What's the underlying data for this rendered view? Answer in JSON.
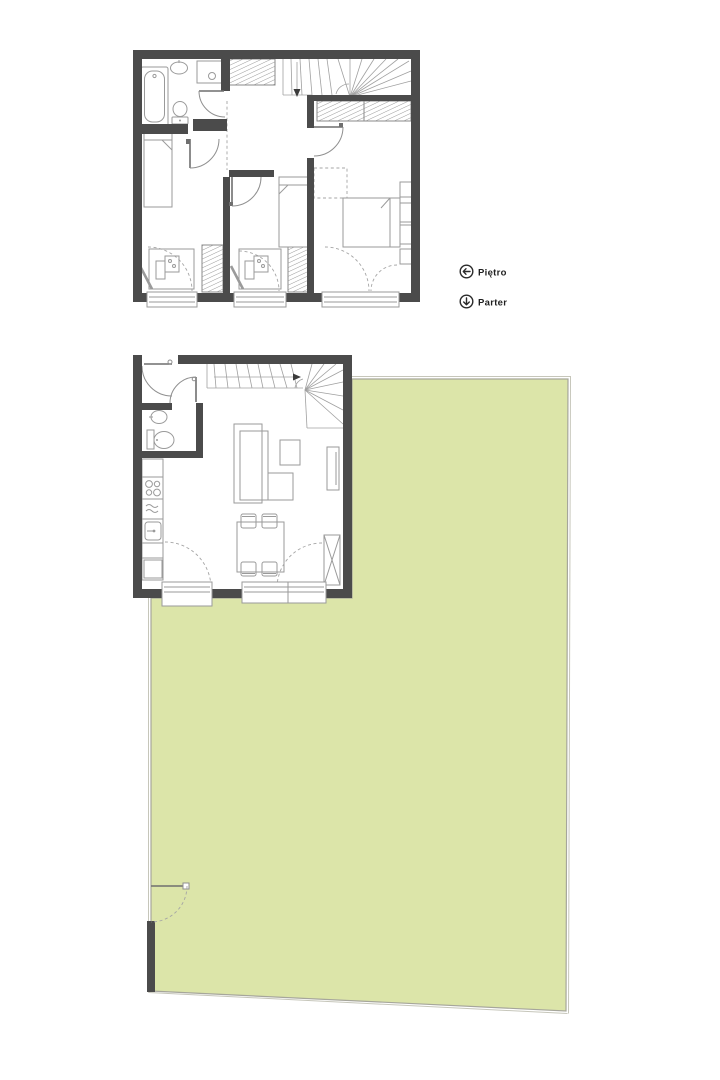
{
  "page": {
    "kind": "architectural-floor-plan",
    "background": "#ffffff",
    "width": 720,
    "height": 1080
  },
  "palette": {
    "wall": "#4b4b4b",
    "furniture_line": "#9a9a9a",
    "door_line": "#8f8f8f",
    "garden_fill": "#dce5a9",
    "garden_border": "#a6a69b",
    "garden_border_light": "#c6c6ba",
    "label_text": "#1f1f1f"
  },
  "legend": {
    "items": [
      {
        "id": "pietro",
        "label": "Piętro",
        "icon": "arrow-left-circle-icon"
      },
      {
        "id": "parter",
        "label": "Parter",
        "icon": "arrow-down-circle-icon"
      }
    ]
  },
  "plans": {
    "upper_floor": {
      "label": "Piętro",
      "rooms": [
        "bathroom",
        "hall",
        "bedroom-left",
        "bedroom-middle",
        "bedroom-right"
      ],
      "fixtures": [
        "bathtub",
        "washbasin",
        "washing-machine",
        "toilet",
        "winder-stairs",
        "wardrobes",
        "single-beds",
        "desks-with-chairs",
        "double-bed",
        "windows",
        "french-door"
      ]
    },
    "ground_floor": {
      "label": "Parter",
      "rooms": [
        "entry",
        "wc",
        "kitchen",
        "living-room",
        "dining-area"
      ],
      "fixtures": [
        "winder-stairs",
        "washbasin",
        "toilet",
        "kitchen-counter",
        "hob",
        "kitchen-sink",
        "sofa",
        "coffee-table",
        "ottoman",
        "tv-unit",
        "dining-table",
        "chairs",
        "terrace-doors",
        "storage-x"
      ]
    }
  },
  "garden": {
    "description": "garden-lawn",
    "gate": "bottom-left-gate"
  }
}
